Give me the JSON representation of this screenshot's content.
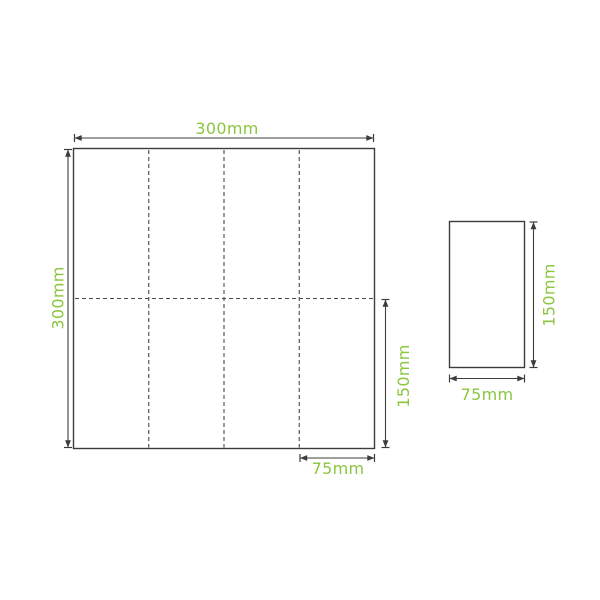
{
  "colors": {
    "accent_green": "#8CC63F",
    "line_dark": "#3C3C3B",
    "fold_line": "#4A4A4A",
    "background": "#FFFFFF"
  },
  "unfolded_sheet": {
    "width_label": "300mm",
    "height_label": "300mm",
    "half_height_label": "150mm",
    "quarter_width_label": "75mm",
    "width_mm": 300,
    "height_mm": 300,
    "fold_columns": 4,
    "fold_rows": 2
  },
  "folded_sheet": {
    "height_label": "150mm",
    "width_label": "75mm",
    "width_mm": 75,
    "height_mm": 150
  }
}
